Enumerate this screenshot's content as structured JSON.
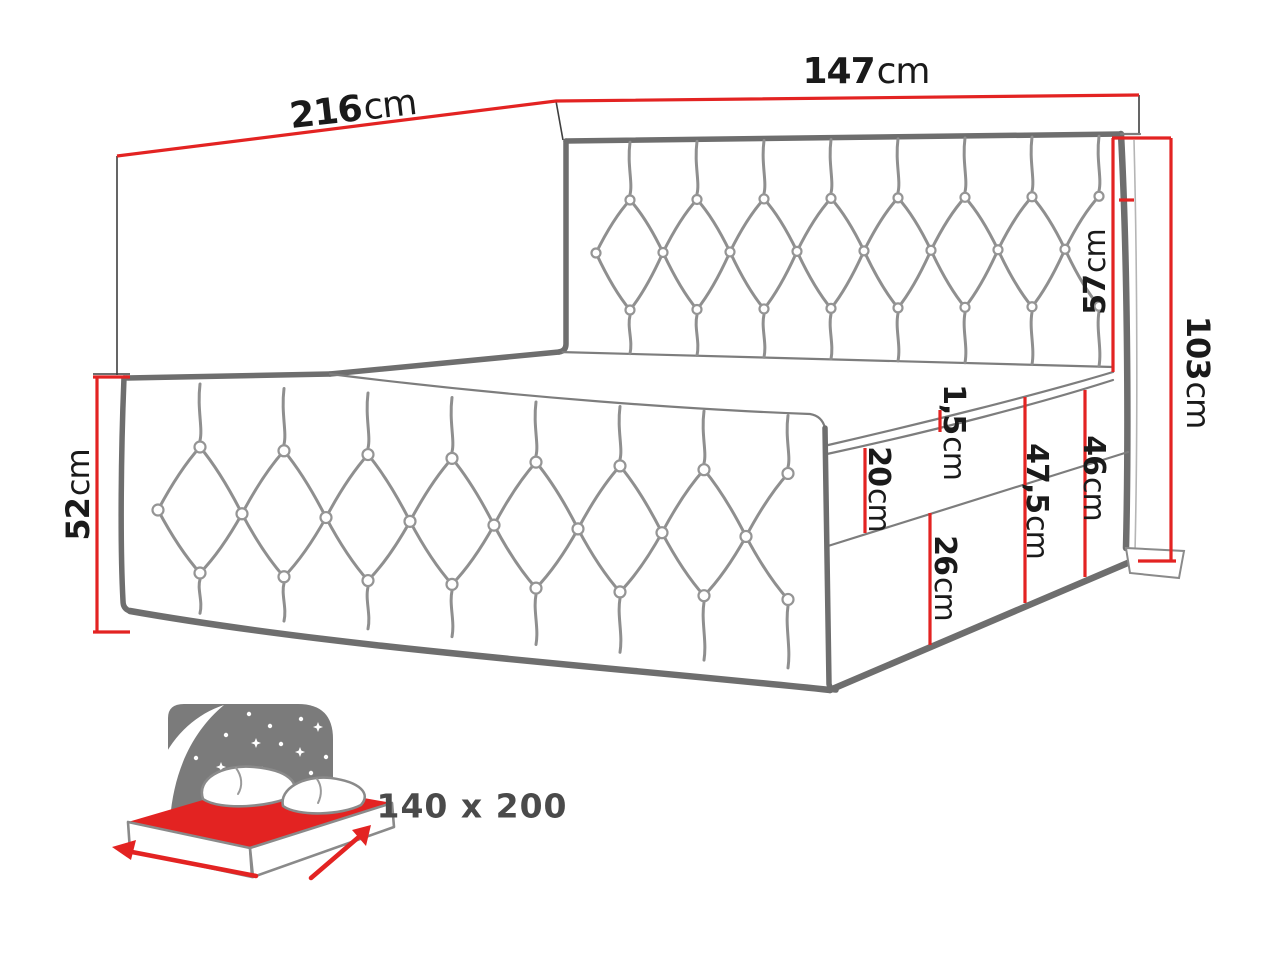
{
  "dims": {
    "length": {
      "value": "216",
      "unit": "cm"
    },
    "width": {
      "value": "147",
      "unit": "cm"
    },
    "headboard_height": {
      "value": "57",
      "unit": "cm"
    },
    "overall_height": {
      "value": "103",
      "unit": "cm"
    },
    "footboard_height": {
      "value": "52",
      "unit": "cm"
    },
    "topper_thickness": {
      "value": "1,5",
      "unit": "cm"
    },
    "mattress_height": {
      "value": "20",
      "unit": "cm"
    },
    "lower_box_height": {
      "value": "26",
      "unit": "cm"
    },
    "base_height": {
      "value": "47,5",
      "unit": "cm"
    },
    "side_rail_height": {
      "value": "46",
      "unit": "cm"
    }
  },
  "size_icon": {
    "size_label": "140 x 200"
  },
  "colors": {
    "dimension_red": "#e32322",
    "line_gray": "#6e6e6e",
    "icon_gray": "#7b7b7b",
    "label_black": "#1a1a1a",
    "size_text_gray": "#4a4a4a"
  }
}
